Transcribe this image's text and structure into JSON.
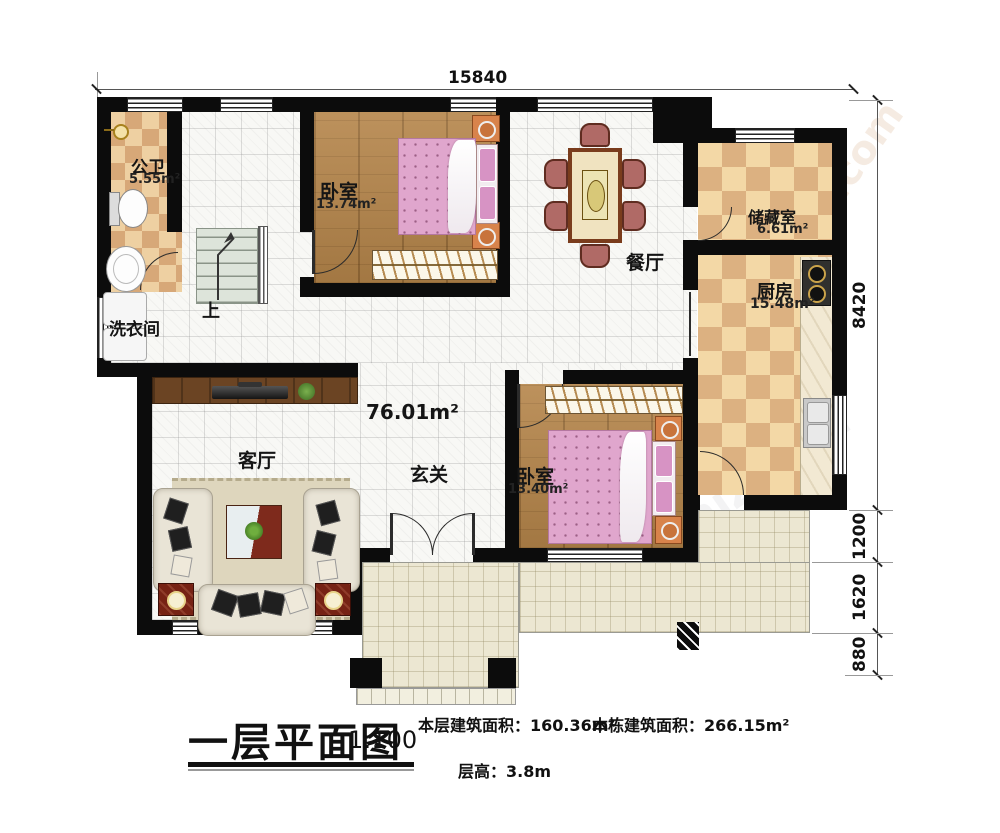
{
  "watermark": {
    "text": "baijuniz.com"
  },
  "dims": {
    "top": "15840",
    "right": [
      "8420",
      "1200",
      "1620",
      "880"
    ]
  },
  "rooms": {
    "bathroom": {
      "name": "公卫",
      "area": "5.55m²"
    },
    "laundry": {
      "name": "洗衣间"
    },
    "stairs": {
      "up": "上"
    },
    "bedroom_top": {
      "name": "卧室",
      "area": "13.74m²"
    },
    "dining": {
      "name": "餐厅"
    },
    "storage": {
      "name": "储藏室",
      "area": "6.61m²"
    },
    "kitchen": {
      "name": "厨房",
      "area": "15.48m²"
    },
    "living": {
      "name": "客厅"
    },
    "foyer": {
      "name": "玄关"
    },
    "bedroom_bottom": {
      "name": "卧室",
      "area": "13.40m²"
    },
    "floor_area": "76.01m²"
  },
  "titleblock": {
    "title": "一层平面图",
    "scale": "1:100",
    "this_floor_label": "本层建筑面积：",
    "this_floor_value": "160.36m²",
    "building_label": "本栋建筑面积：",
    "building_value": "266.15m²",
    "height_label": "层高：",
    "height_value": "3.8m"
  }
}
